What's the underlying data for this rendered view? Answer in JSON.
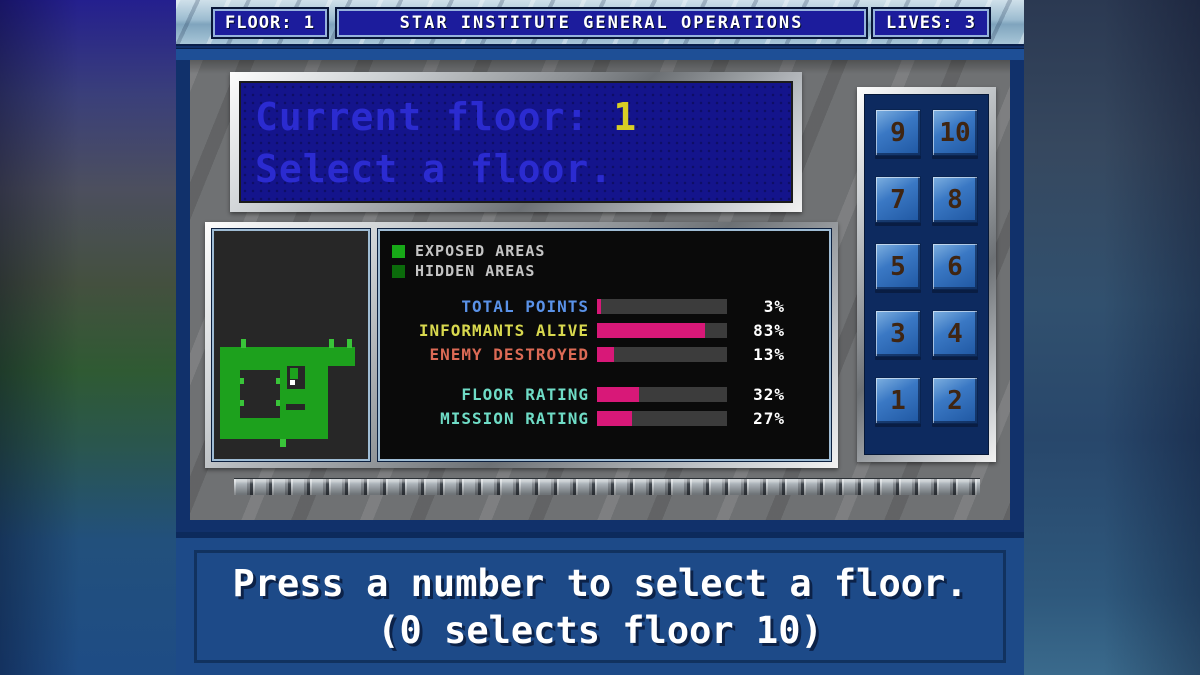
{
  "top_bar": {
    "floor_label": "FLOOR: 1",
    "title": "STAR INSTITUTE GENERAL OPERATIONS",
    "lives_label": "LIVES: 3"
  },
  "display": {
    "line1_label": "Current floor:",
    "current_floor": "1",
    "line2": "Select a floor."
  },
  "map": {
    "wall_color": "#1da11d",
    "tick_color": "#39c439",
    "background": "#272727",
    "player_color": "#ffffff"
  },
  "legend": {
    "exposed": {
      "label": "EXPOSED AREAS",
      "color": "#17a817"
    },
    "hidden": {
      "label": "HIDDEN AREAS",
      "color": "#0b6b0b"
    }
  },
  "stats": {
    "bar_fill": "#d81878",
    "bar_track": "#3c3c3c",
    "rows": [
      {
        "label": "TOTAL POINTS",
        "value": 3,
        "pct": "3%",
        "label_color": "#5a92e8"
      },
      {
        "label": "INFORMANTS ALIVE",
        "value": 83,
        "pct": "83%",
        "label_color": "#d8d84e"
      },
      {
        "label": "ENEMY DESTROYED",
        "value": 13,
        "pct": "13%",
        "label_color": "#dc6a55"
      },
      {
        "label": "FLOOR RATING",
        "value": 32,
        "pct": "32%",
        "label_color": "#6fdcc6"
      },
      {
        "label": "MISSION RATING",
        "value": 27,
        "pct": "27%",
        "label_color": "#6fdcc6"
      }
    ]
  },
  "keypad": {
    "buttons": [
      "9",
      "10",
      "7",
      "8",
      "5",
      "6",
      "3",
      "4",
      "1",
      "2"
    ]
  },
  "message": {
    "line1": "Press a number to select a floor.",
    "line2": "(0 selects floor 10)"
  }
}
